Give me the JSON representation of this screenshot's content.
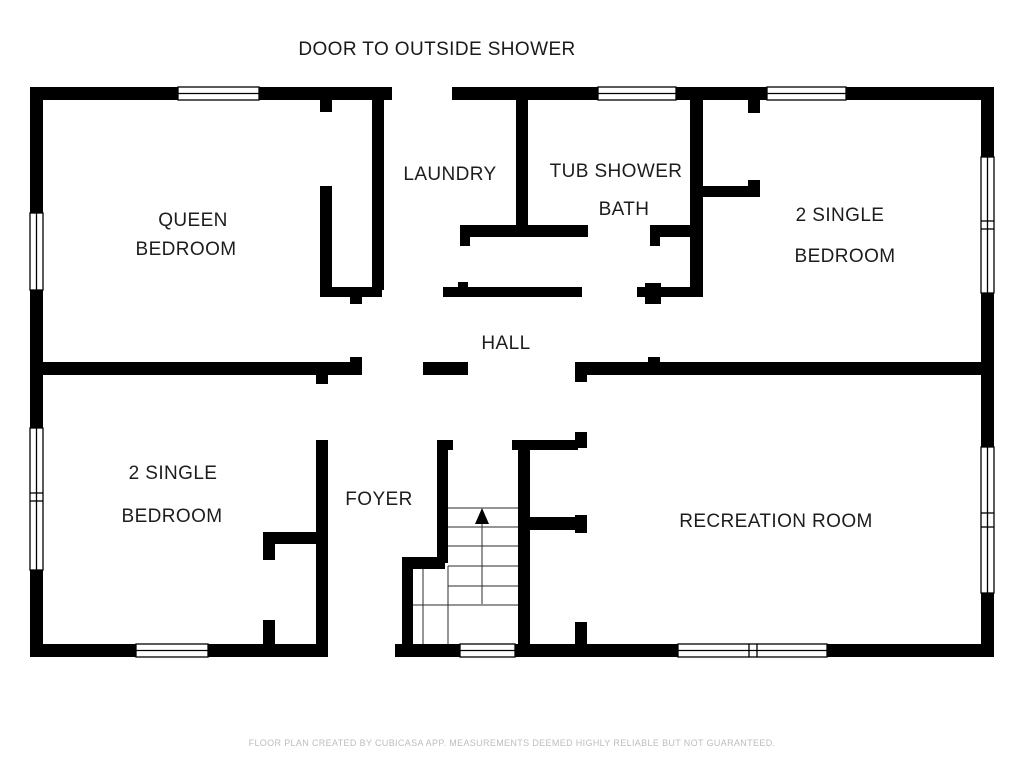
{
  "title": "DOOR TO OUTSIDE SHOWER",
  "footer": "FLOOR PLAN CREATED BY CUBICASA APP. MEASUREMENTS DEEMED HIGHLY RELIABLE BUT NOT GUARANTEED.",
  "colors": {
    "wall": "#000000",
    "background": "#ffffff",
    "label": "#1d1d1d",
    "footer_text": "#bdbdbd"
  },
  "labels": {
    "queen_1": "QUEEN",
    "queen_2": "BEDROOM",
    "laundry": "LAUNDRY",
    "bath_1": "TUB SHOWER",
    "bath_2": "BATH",
    "single_right_1": "2 SINGLE",
    "single_right_2": "BEDROOM",
    "hall": "HALL",
    "single_left_1": "2 SINGLE",
    "single_left_2": "BEDROOM",
    "foyer": "FOYER",
    "rec": "RECREATION ROOM"
  },
  "icons": {
    "stairs_arrow": "stairs-direction-up-arrow"
  }
}
